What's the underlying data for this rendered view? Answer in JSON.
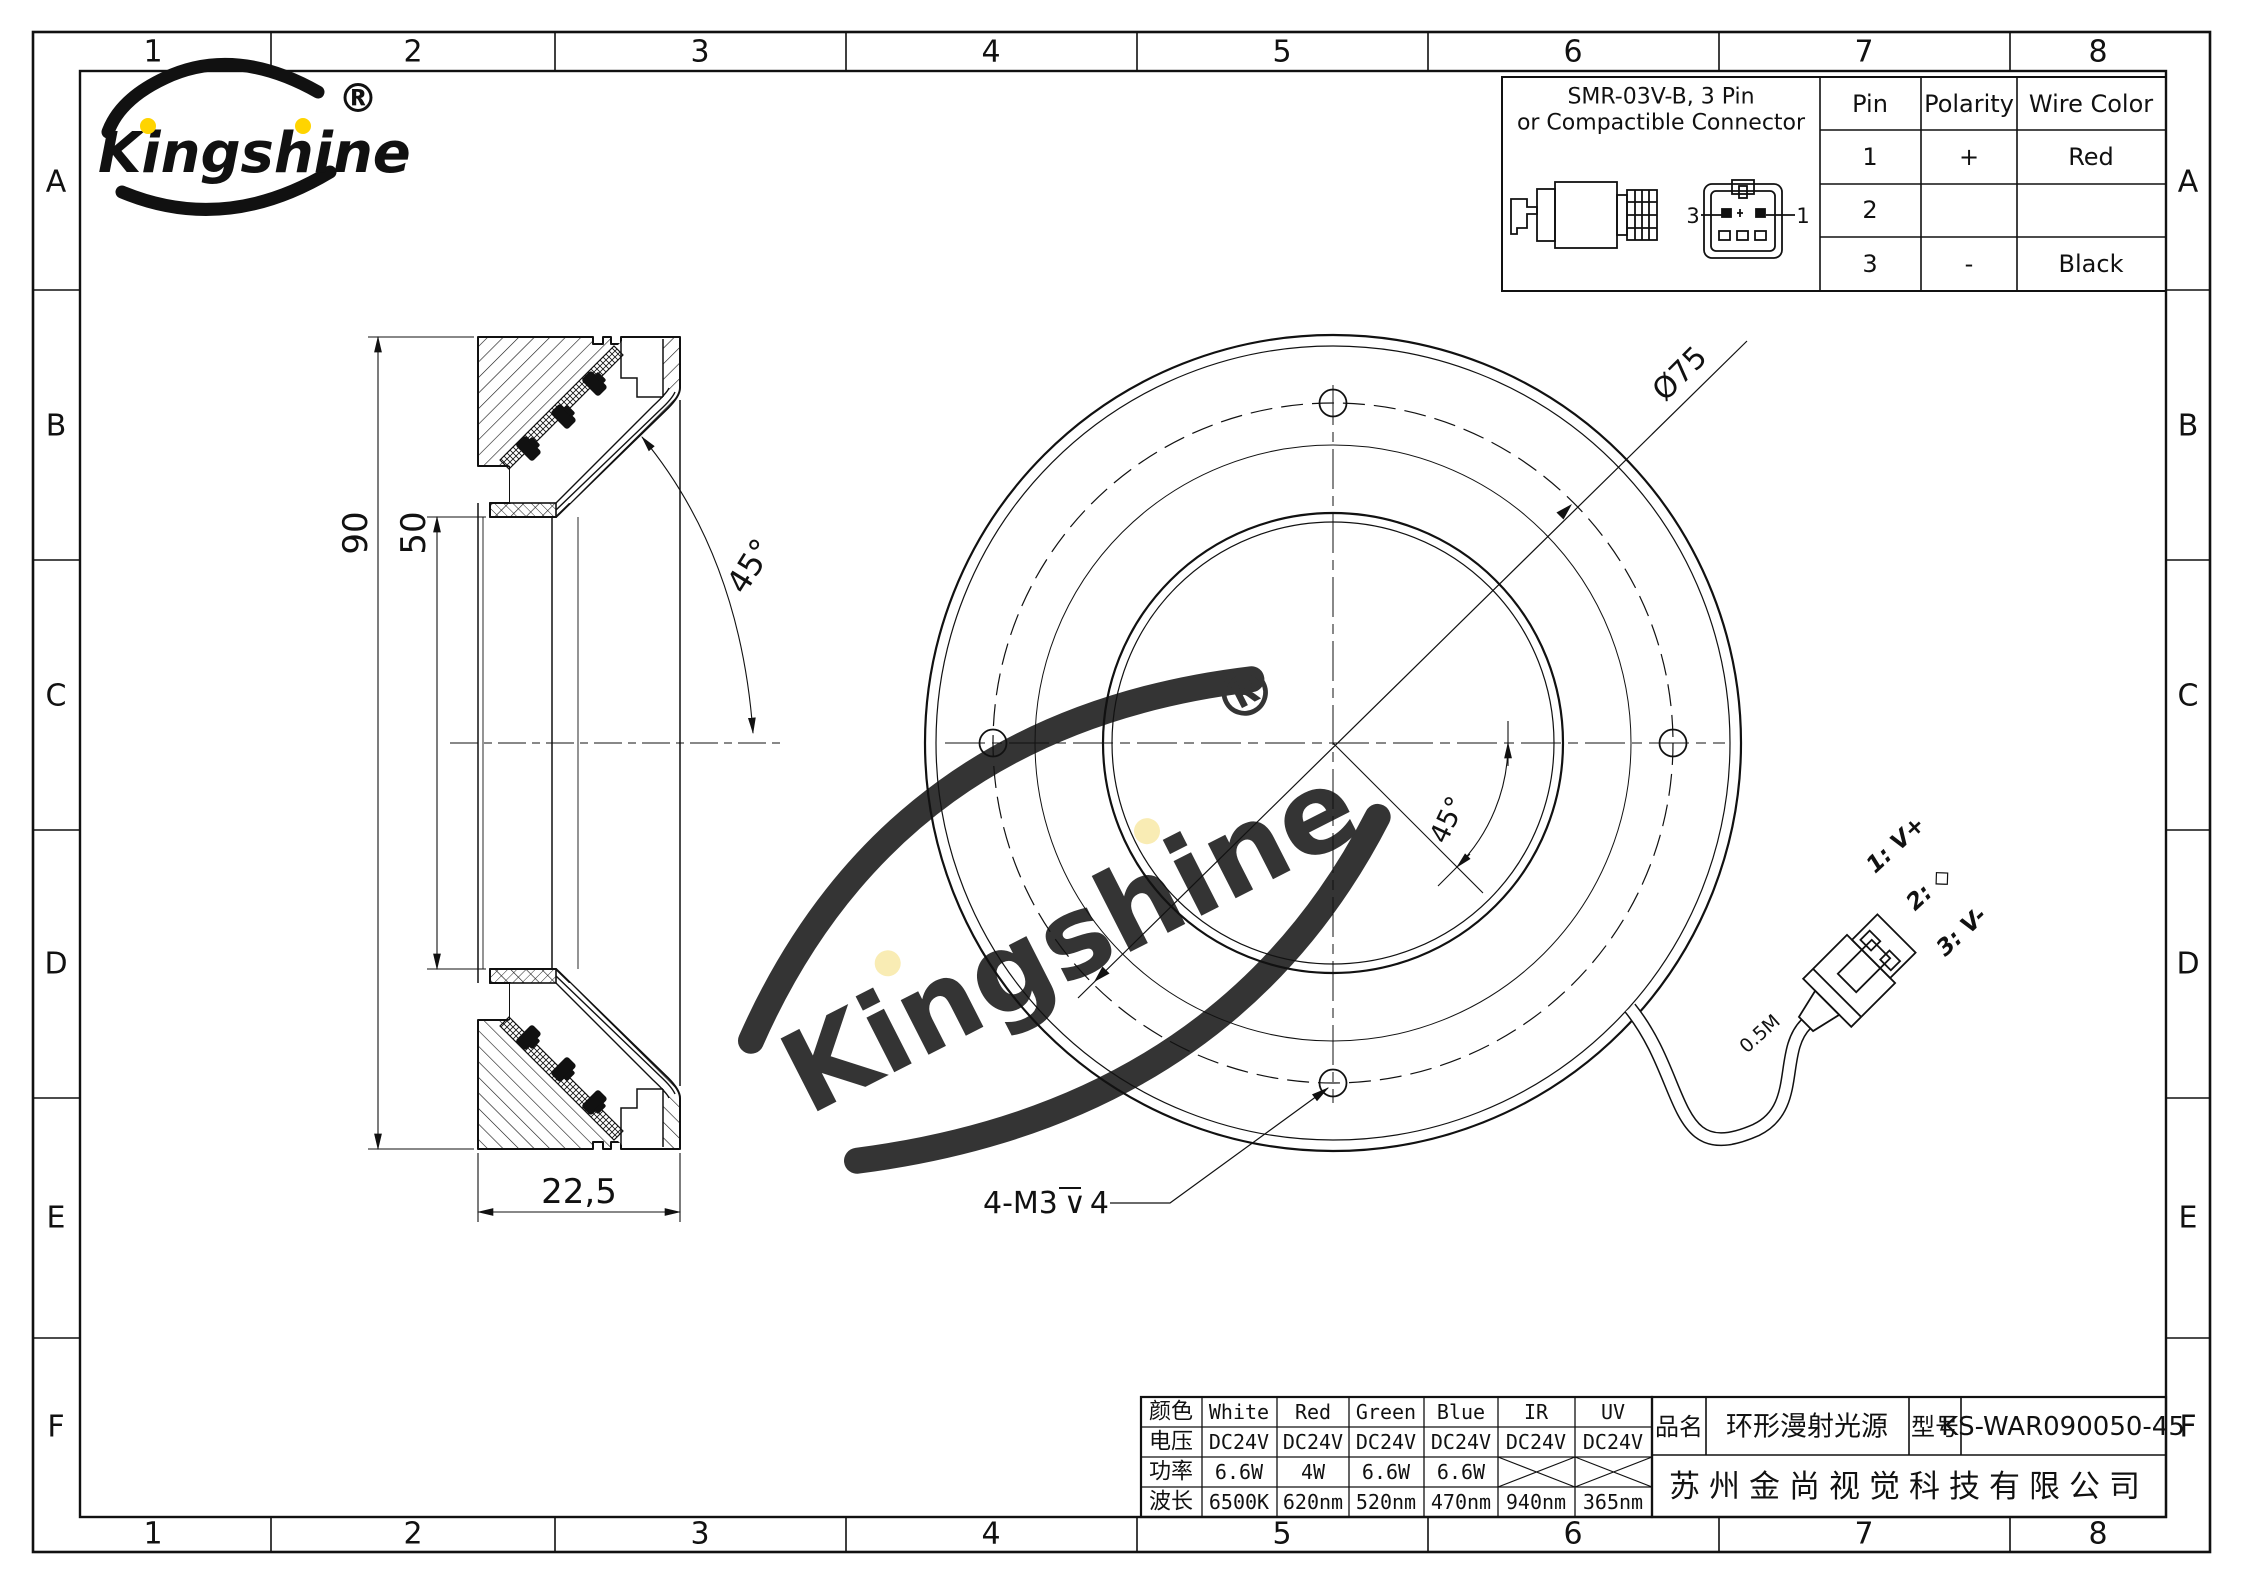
{
  "logo": {
    "brand": "Kingshine",
    "registered": "®"
  },
  "watermark": {
    "brand": "Kingshine",
    "registered": "®"
  },
  "grid": {
    "cols": [
      "1",
      "2",
      "3",
      "4",
      "5",
      "6",
      "7",
      "8"
    ],
    "rows": [
      "A",
      "B",
      "C",
      "D",
      "E",
      "F"
    ]
  },
  "connector_info": {
    "title_line1": "SMR-03V-B, 3 Pin",
    "title_line2": "or Compactible Connector",
    "pin3_label": "3",
    "pin1_label": "1",
    "table": {
      "headers": [
        "Pin",
        "Polarity",
        "Wire Color"
      ],
      "rows": [
        [
          "1",
          "+",
          "Red"
        ],
        [
          "2",
          "",
          ""
        ],
        [
          "3",
          "-",
          "Black"
        ]
      ]
    }
  },
  "section_view": {
    "dim_height": "90",
    "dim_inner": "50",
    "dim_depth": "22,5",
    "dim_angle": "45°"
  },
  "front_view": {
    "dim_bolt_circle": "Ø75",
    "dim_angle": "45°",
    "thread_note": {
      "prefix": "4-M3",
      "depth_symbol": "∨",
      "suffix": "4"
    },
    "cable_length": "0.5M",
    "pin_labels": [
      "1: V+",
      "2: ◇",
      "3: V-"
    ]
  },
  "spec_table": {
    "row_labels": [
      "颜色",
      "电压",
      "功率",
      "波长"
    ],
    "colors": [
      "White",
      "Red",
      "Green",
      "Blue",
      "IR",
      "UV"
    ],
    "voltage": [
      "DC24V",
      "DC24V",
      "DC24V",
      "DC24V",
      "DC24V",
      "DC24V"
    ],
    "power": [
      "6.6W",
      "4W",
      "6.6W",
      "6.6W",
      "",
      ""
    ],
    "wavelength": [
      "6500K",
      "620nm",
      "520nm",
      "470nm",
      "940nm",
      "365nm"
    ]
  },
  "title_block": {
    "name_label": "品名",
    "name_value": "环形漫射光源",
    "model_label": "型号",
    "model_value": "KS-WAR090050-45",
    "company": "苏州金尚视觉科技有限公司"
  },
  "accent_colors": {
    "logo_dark_blue": "#1565b0",
    "logo_light_blue": "#29a8e0",
    "logo_yellow": "#ffd400",
    "watermark_blue": "#cdeaf8",
    "watermark_yellow": "#f8e9a8"
  }
}
